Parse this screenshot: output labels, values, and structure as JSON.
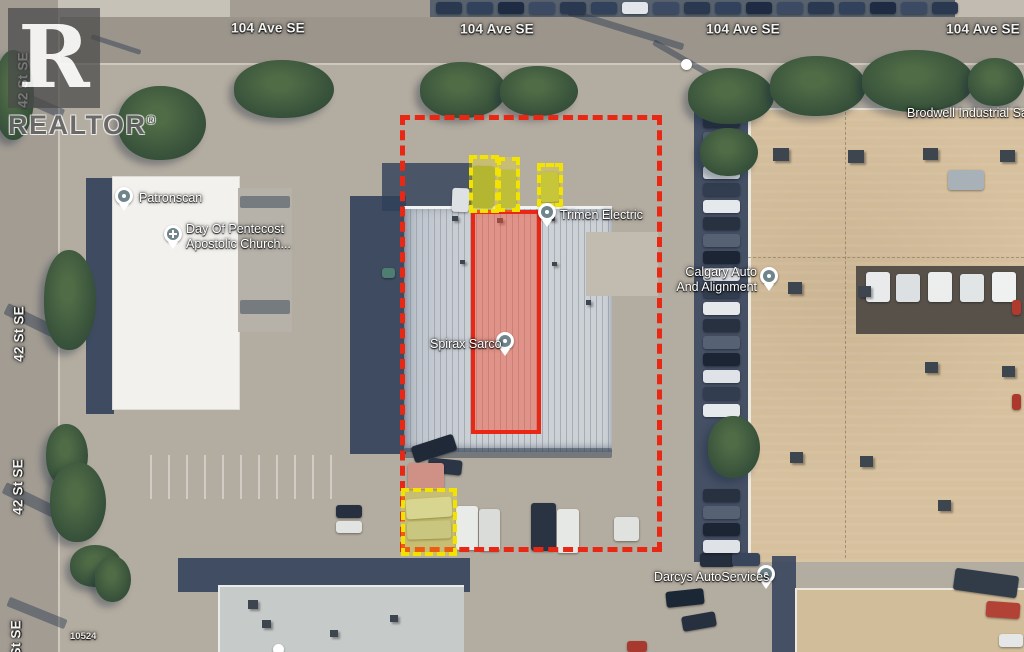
{
  "watermark": {
    "letter": "R",
    "name": "REALTOR",
    "symbol": "®"
  },
  "streets": {
    "avenue": "104 Ave SE",
    "street": "42 St SE"
  },
  "pois": {
    "patronscan": {
      "label": "Patronscan"
    },
    "church": {
      "line1": "Day Of Pentecost",
      "line2": "Apostolic Church..."
    },
    "trimen": {
      "label": "Trimen Electric"
    },
    "spirax": {
      "label": "Spirax Sarco"
    },
    "calgary": {
      "line1": "Calgary Auto",
      "line2": "And Alignment"
    },
    "brodwell": {
      "label": "Brodwell Industrial Sales"
    },
    "darcys": {
      "label": "Darcys AutoServices"
    }
  },
  "parcel": {
    "number": "10524"
  },
  "annotations": {
    "boundary_color": "#e82815",
    "highlight_border": "#e82815",
    "highlight_fill": "rgba(243,85,58,0.5)",
    "vehicle_box_color": "#f2e400",
    "vehicle_box_fill": "rgba(250,235,0,0.28)"
  }
}
